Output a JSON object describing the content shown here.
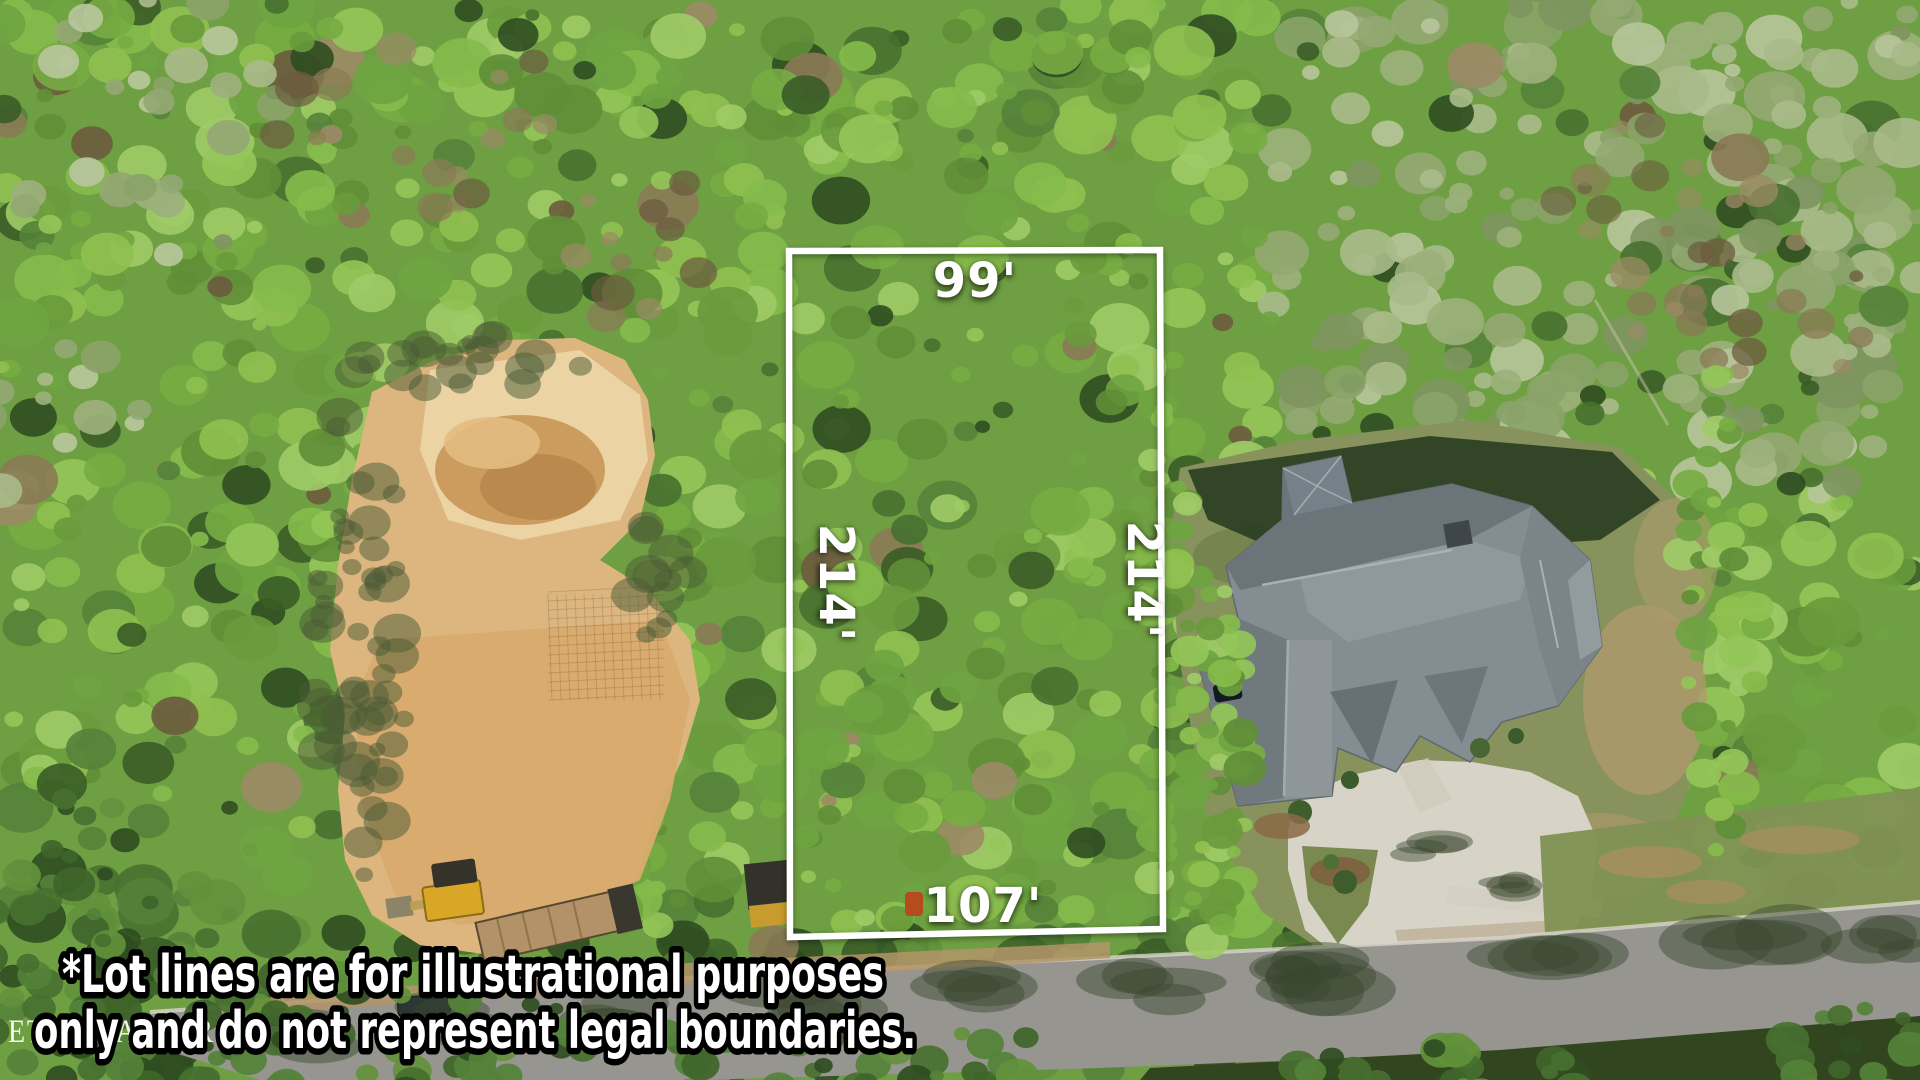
{
  "lot": {
    "top_label": "99'",
    "left_label": "214'",
    "right_label": "214'",
    "bottom_label": "107'",
    "line_color": "#ffffff"
  },
  "disclaimer": {
    "line1": "*Lot lines are for illustrational purposes",
    "line2": "only and do not represent legal boundaries.",
    "text_color": "#ffffff",
    "outline_color": "#000000"
  },
  "watermark": {
    "text": "ETN REALTORS",
    "color": "#ffffff"
  }
}
